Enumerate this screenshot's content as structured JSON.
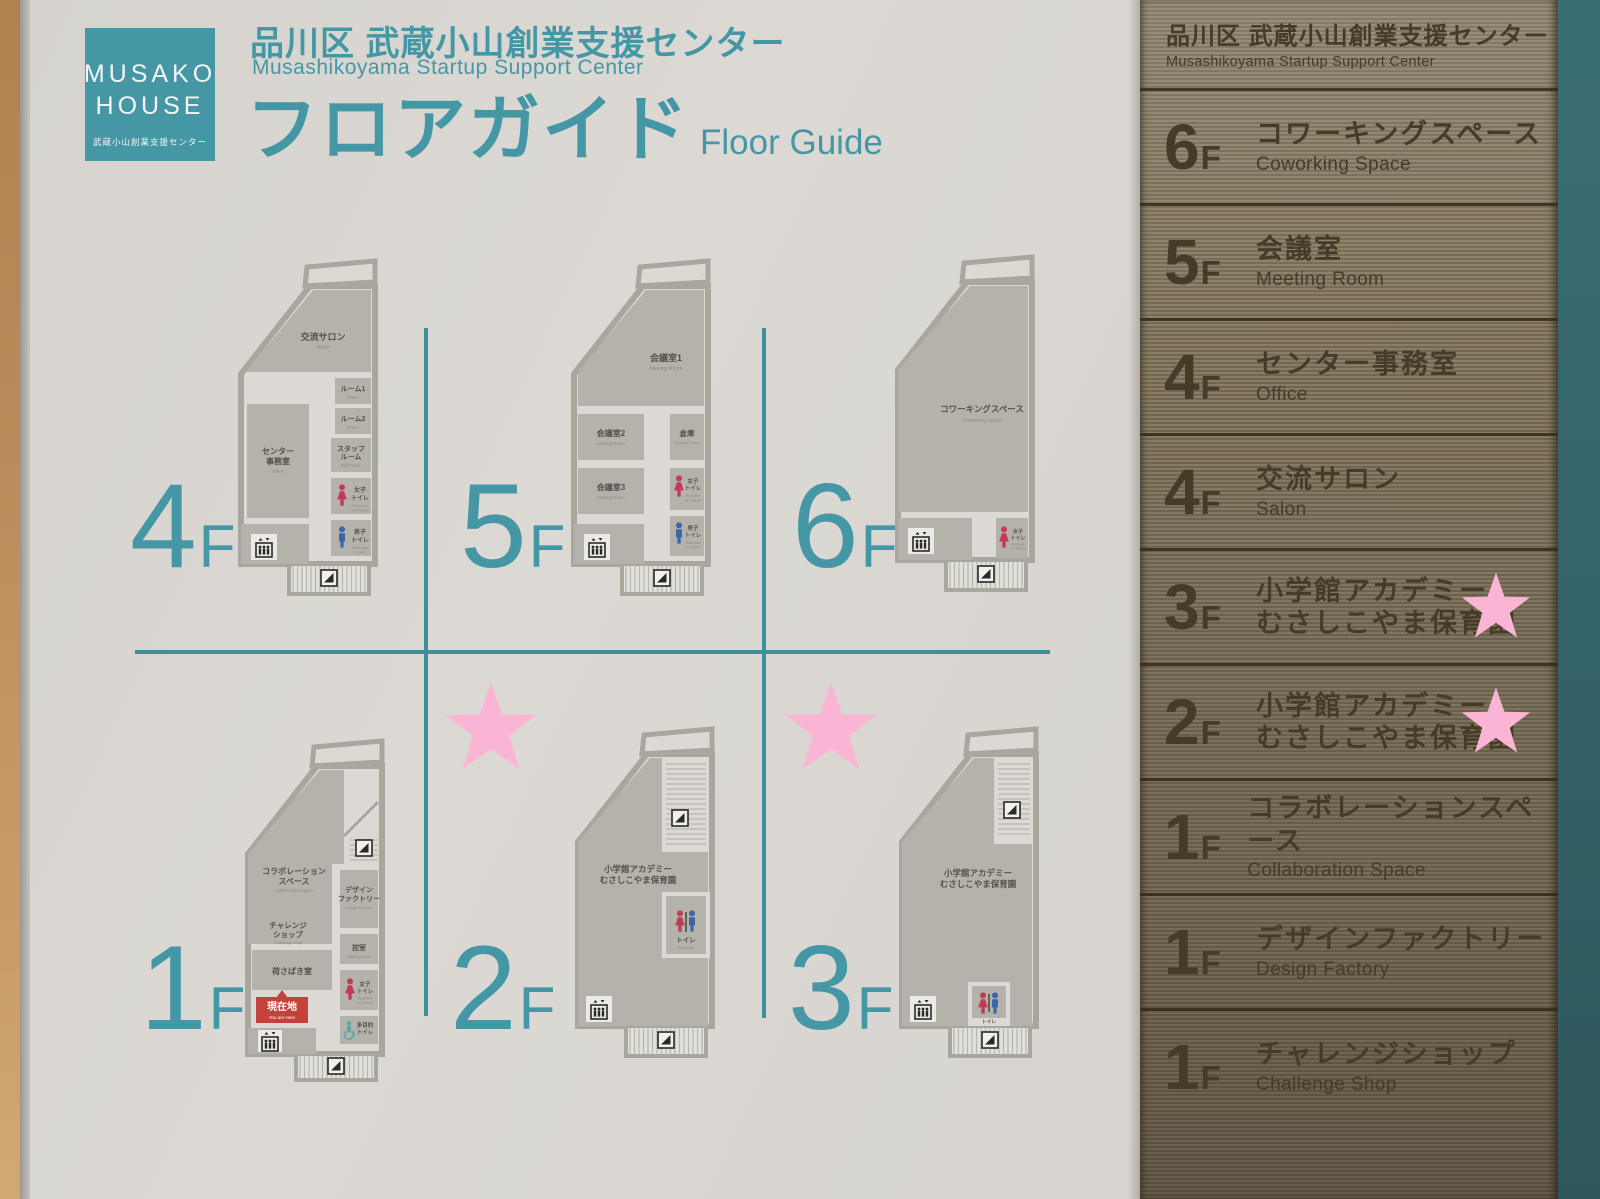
{
  "colors": {
    "teal": "#4597a6",
    "teal_line": "#3f8f9b",
    "board_bg": "#d9d6d1",
    "room_gray": "#b5b2ab",
    "wall": "#a9a69e",
    "plan_text": "#53514a",
    "plan_text_light": "#8d8a82",
    "panel_text": "#453b29",
    "star_pink": "#f9b5d3",
    "female_red": "#c23a55",
    "male_blue": "#3a65a8",
    "multi_teal": "#52a8ad",
    "here_red": "#c4423a",
    "wood": "#b98a5a",
    "teal_strip": "#386a70"
  },
  "header": {
    "logo_line1": "MUSAKO",
    "logo_line2": "HOUSE",
    "logo_sub": "武蔵小山創業支援センター",
    "title_ja": "品川区 武蔵小山創業支援センター",
    "title_en": "Musashikoyama Startup Support Center",
    "heading_ja": "フロアガイド",
    "heading_en": "Floor Guide"
  },
  "floors": {
    "f4": {
      "num": "4",
      "suffix": "F",
      "salon_ja": "交流サロン",
      "salon_en": "Salon",
      "room1_ja": "ルーム1",
      "room1_en": "Room",
      "room2_ja": "ルーム2",
      "room2_en": "Room",
      "staff_ja1": "スタッフ",
      "staff_ja2": "ルーム",
      "staff_en": "Staff Room",
      "office_ja1": "センター",
      "office_ja2": "事務室",
      "office_en": "Office",
      "wt_ja1": "女子",
      "wt_ja2": "トイレ",
      "wt_en1": "Restroom",
      "wt_en2": "for Women",
      "mt_ja1": "男子",
      "mt_ja2": "トイレ",
      "mt_en1": "Restroom",
      "mt_en2": "for Men"
    },
    "f5": {
      "num": "5",
      "suffix": "F",
      "m1_ja": "会議室1",
      "m1_en": "Meeting Room",
      "m2_ja": "会議室2",
      "m2_en": "Meeting Room",
      "st_ja": "倉庫",
      "st_en": "Storage Room",
      "m3_ja": "会議室3",
      "m3_en": "Meeting Room",
      "wt_ja1": "女子",
      "wt_ja2": "トイレ",
      "wt_en1": "Restroom",
      "wt_en2": "for Women",
      "mt_ja1": "男子",
      "mt_ja2": "トイレ",
      "mt_en1": "Restroom",
      "mt_en2": "for Men"
    },
    "f6": {
      "num": "6",
      "suffix": "F",
      "cw_ja": "コワーキングスペース",
      "cw_en": "Coworking Space",
      "wt_ja1": "女子",
      "wt_ja2": "トイレ",
      "wt_en1": "Restroom",
      "wt_en2": "for Women"
    },
    "f1": {
      "num": "1",
      "suffix": "F",
      "collab_ja1": "コラボレーション",
      "collab_ja2": "スペース",
      "collab_en": "Collaboration Space",
      "cs_ja1": "チャレンジ",
      "cs_ja2": "ショップ",
      "cs_en": "Challenge Shop",
      "load_ja": "荷さばき室",
      "df_ja1": "デザイン",
      "df_ja2": "ファクトリー",
      "df_en": "Design Factory",
      "wait_ja": "控室",
      "wait_en": "Waiting Room",
      "wt_ja1": "女子",
      "wt_ja2": "トイレ",
      "wt_en1": "Restroom",
      "wt_en2": "for Women",
      "multi_ja1": "多目的",
      "multi_ja2": "トイレ",
      "here_ja": "現在地",
      "here_en": "You are Here"
    },
    "f2": {
      "num": "2",
      "suffix": "F",
      "n_ja1": "小学館アカデミー",
      "n_ja2": "むさしこやま保育園",
      "t_ja": "トイレ",
      "t_en": "Restroom"
    },
    "f3": {
      "num": "3",
      "suffix": "F",
      "n_ja1": "小学館アカデミー",
      "n_ja2": "むさしこやま保育園",
      "t_ja": "トイレ",
      "t_en": "Restroom"
    }
  },
  "directory": {
    "header_ja": "品川区 武蔵小山創業支援センター",
    "header_en": "Musashikoyama Startup Support Center",
    "rows": [
      {
        "floor": "6",
        "suffix": "F",
        "ja": "コワーキングスペース",
        "en": "Coworking Space",
        "star": false
      },
      {
        "floor": "5",
        "suffix": "F",
        "ja": "会議室",
        "en": "Meeting Room",
        "star": false
      },
      {
        "floor": "4",
        "suffix": "F",
        "ja": "センター事務室",
        "en": "Office",
        "star": false
      },
      {
        "floor": "4",
        "suffix": "F",
        "ja": "交流サロン",
        "en": "Salon",
        "star": false
      },
      {
        "floor": "3",
        "suffix": "F",
        "ja": "小学館アカデミー",
        "ja2": "むさしこやま保育園",
        "en": "",
        "star": true
      },
      {
        "floor": "2",
        "suffix": "F",
        "ja": "小学館アカデミー",
        "ja2": "むさしこやま保育園",
        "en": "",
        "star": true
      },
      {
        "floor": "1",
        "suffix": "F",
        "ja": "コラボレーションスペース",
        "en": "Collaboration Space",
        "star": false
      },
      {
        "floor": "1",
        "suffix": "F",
        "ja": "デザインファクトリー",
        "en": "Design Factory",
        "star": false
      },
      {
        "floor": "1",
        "suffix": "F",
        "ja": "チャレンジショップ",
        "en": "Challenge Shop",
        "star": false
      }
    ]
  }
}
